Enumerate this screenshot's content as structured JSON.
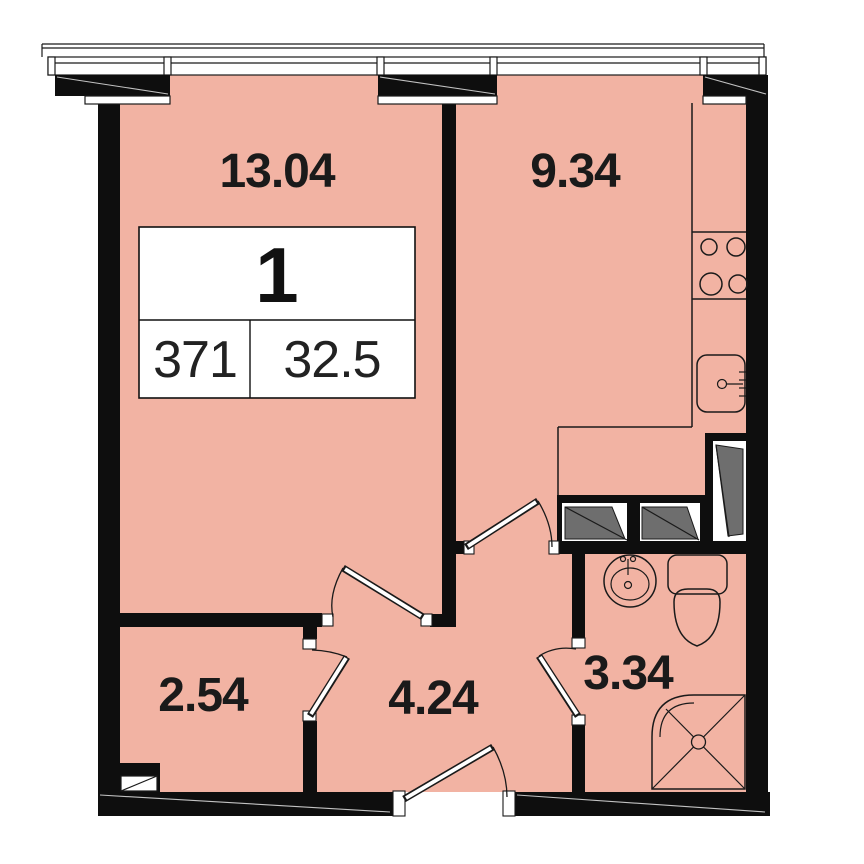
{
  "plan": {
    "type": "apartment-floor-plan",
    "colors": {
      "floor": "#F2B3A3",
      "wall": "#0E0E0E",
      "line": "#1A1A1A",
      "hatch": "#6E6E6E",
      "paper": "#FFFFFF"
    },
    "labels": {
      "living": "13.04",
      "kitchen": "9.34",
      "closet": "2.54",
      "hall": "4.24",
      "bath": "3.34"
    },
    "card": {
      "rooms": "1",
      "number": "371",
      "area": "32.5"
    },
    "fixtures": [
      "window-icon",
      "balcony-edge",
      "stove-icon",
      "kitchen-sink-icon",
      "wardrobe-icon",
      "bathroom-sink-icon",
      "toilet-icon",
      "shower-icon",
      "door-icon",
      "electrical-panel-icon"
    ]
  }
}
